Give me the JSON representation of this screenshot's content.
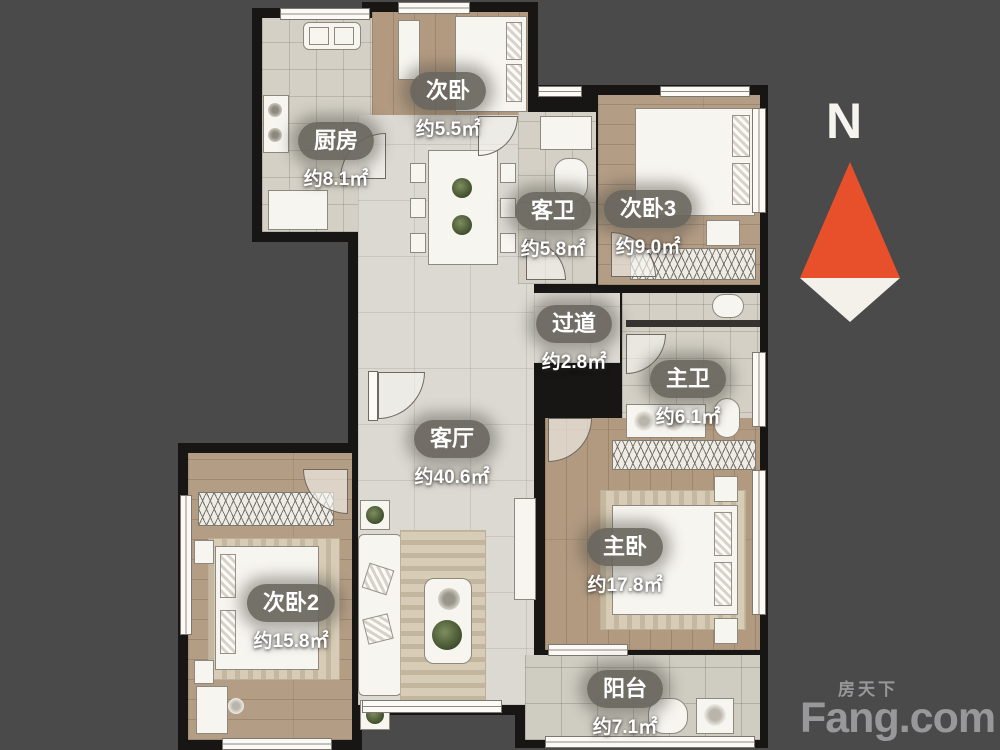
{
  "background_color": "#4a4a4b",
  "wall_color": "#171614",
  "rooms": [
    {
      "id": "bedroom-top",
      "name": "次卧",
      "area": "约5.5㎡"
    },
    {
      "id": "kitchen",
      "name": "厨房",
      "area": "约8.1㎡"
    },
    {
      "id": "guest-bath",
      "name": "客卫",
      "area": "约5.8㎡"
    },
    {
      "id": "bedroom3",
      "name": "次卧3",
      "area": "约9.0㎡"
    },
    {
      "id": "hallway",
      "name": "过道",
      "area": "约2.8㎡"
    },
    {
      "id": "master-bath",
      "name": "主卫",
      "area": "约6.1㎡"
    },
    {
      "id": "living-room",
      "name": "客厅",
      "area": "约40.6㎡"
    },
    {
      "id": "master-bedroom",
      "name": "主卧",
      "area": "约17.8㎡"
    },
    {
      "id": "bedroom2",
      "name": "次卧2",
      "area": "约15.8㎡"
    },
    {
      "id": "balcony",
      "name": "阳台",
      "area": "约7.1㎡"
    }
  ],
  "compass": {
    "label": "N",
    "arrow_color": "#e8502b"
  },
  "watermark": {
    "brand_cn": "房天下",
    "brand_en": "Fang.com",
    "color": "#98989a"
  }
}
